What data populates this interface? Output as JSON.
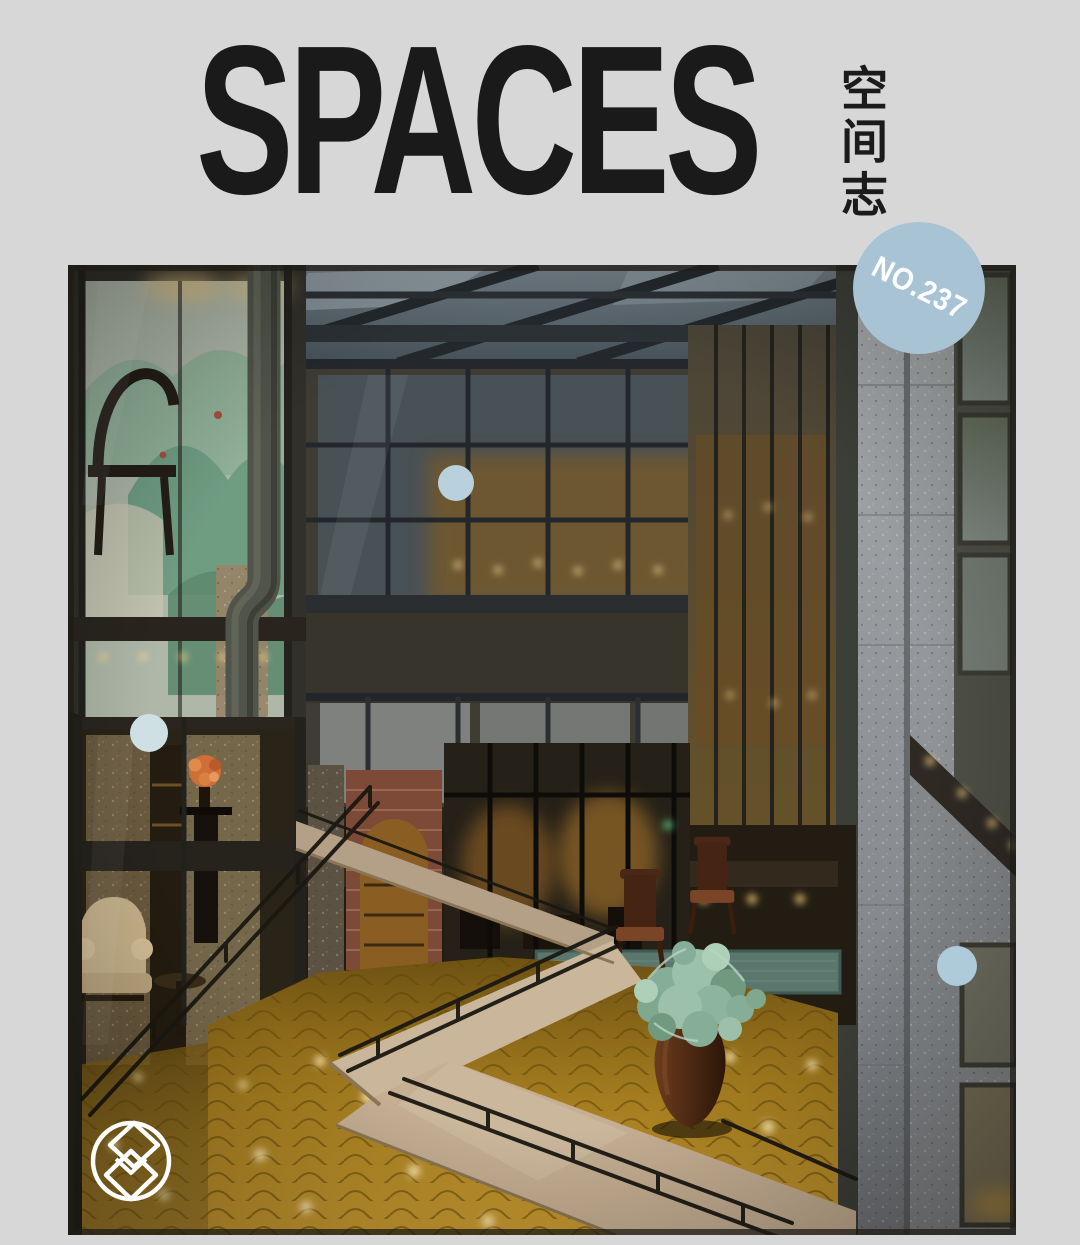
{
  "page": {
    "background_color": "#d7d7d7"
  },
  "masthead": {
    "title": "SPACES",
    "subtitle_vertical": "空间志",
    "title_color": "#1a1a1a"
  },
  "issue_badge": {
    "label": "NO.237",
    "background_color": "#a7c3d4",
    "text_color": "#ffffff"
  },
  "photo": {
    "alt": "Warm lantern-lit interior courtyard of a steel-and-glass renovated building: dark metal frames and skylight, a green landscape mural behind glass on the left, a large curved duct pipe, a glass-railed bridge, rough granite pier and frosted windows on the right, antique armchairs on a teal rug, a zigzag beige stone walkway with thin railings over a golden patterned floor, and a large urn with a wispy green plant"
  },
  "decorations": {
    "dot_color_1": "#b9d1dc",
    "dot_color_2": "#cfe0e4",
    "dot_color_3": "#aecbd9",
    "logo_icon": "stacked-diamonds-icon",
    "logo_color": "#ffffff"
  }
}
